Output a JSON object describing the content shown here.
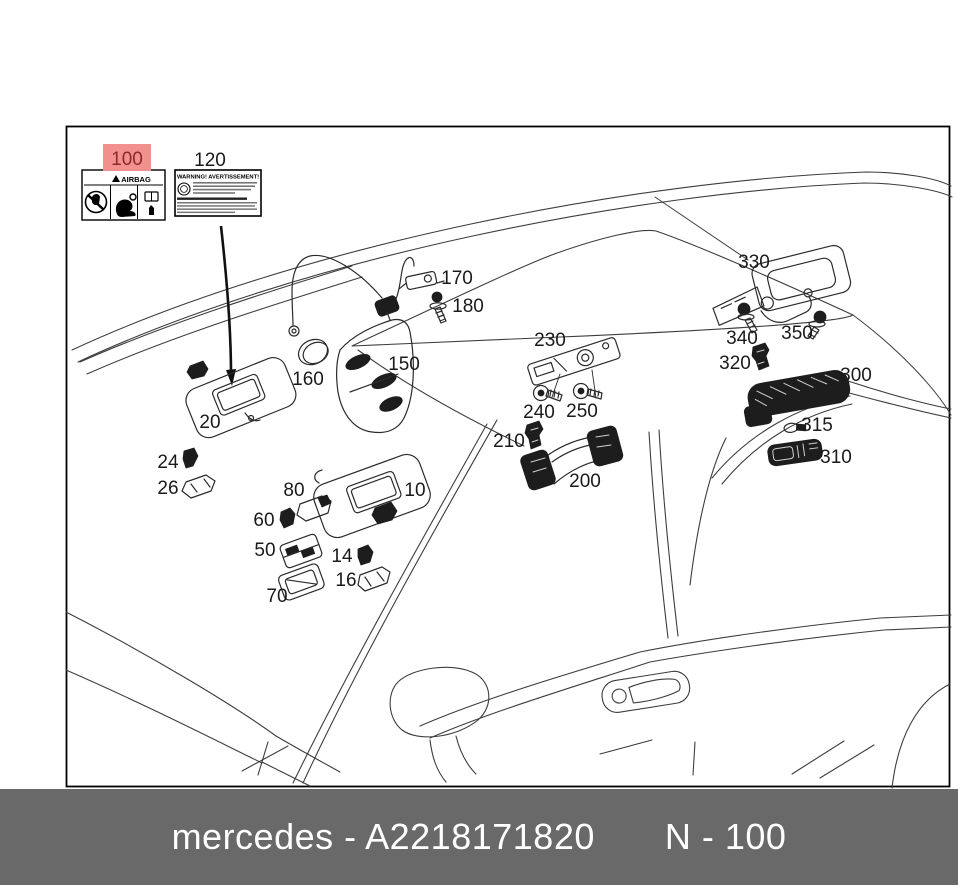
{
  "footer": {
    "part_number": "mercedes - A2218171820",
    "page_ref": "N - 100",
    "bg": "#696969",
    "text_color": "#ffffff"
  },
  "diagram": {
    "frame_color": "#000000",
    "line_color": "#3d3d3d",
    "highlight": {
      "bg": "#f2908e",
      "text": "#8c2b26"
    },
    "airbag_label": {
      "callout": "100",
      "title": "AIRBAG",
      "icons": [
        "warning-triangle-icon",
        "no-child-seat-icon",
        "airbag-child-seat-icon",
        "manual-book-hand-icon"
      ]
    },
    "warning_label": {
      "callout": "120",
      "title": "WARNING! AVERTISSEMENT!",
      "icons": [
        "round-certification-icon"
      ]
    },
    "callouts": [
      {
        "label": "100",
        "x": 127,
        "y": 165,
        "highlighted": true
      },
      {
        "label": "120",
        "x": 210,
        "y": 166,
        "highlighted": false
      },
      {
        "label": "170",
        "x": 457,
        "y": 284,
        "highlighted": false
      },
      {
        "label": "180",
        "x": 468,
        "y": 312,
        "highlighted": false
      },
      {
        "label": "150",
        "x": 404,
        "y": 370,
        "highlighted": false
      },
      {
        "label": "160",
        "x": 308,
        "y": 385,
        "highlighted": false
      },
      {
        "label": "20",
        "x": 210,
        "y": 428,
        "highlighted": false
      },
      {
        "label": "24",
        "x": 168,
        "y": 468,
        "highlighted": false
      },
      {
        "label": "26",
        "x": 168,
        "y": 494,
        "highlighted": false
      },
      {
        "label": "80",
        "x": 294,
        "y": 496,
        "highlighted": false
      },
      {
        "label": "60",
        "x": 264,
        "y": 526,
        "highlighted": false
      },
      {
        "label": "50",
        "x": 265,
        "y": 556,
        "highlighted": false
      },
      {
        "label": "70",
        "x": 277,
        "y": 602,
        "highlighted": false
      },
      {
        "label": "14",
        "x": 342,
        "y": 562,
        "highlighted": false
      },
      {
        "label": "16",
        "x": 346,
        "y": 586,
        "highlighted": false
      },
      {
        "label": "10",
        "x": 415,
        "y": 496,
        "highlighted": false
      },
      {
        "label": "230",
        "x": 550,
        "y": 346,
        "highlighted": false
      },
      {
        "label": "240",
        "x": 539,
        "y": 418,
        "highlighted": false
      },
      {
        "label": "250",
        "x": 582,
        "y": 417,
        "highlighted": false
      },
      {
        "label": "210",
        "x": 509,
        "y": 447,
        "highlighted": false
      },
      {
        "label": "200",
        "x": 585,
        "y": 487,
        "highlighted": false
      },
      {
        "label": "330",
        "x": 754,
        "y": 268,
        "highlighted": false
      },
      {
        "label": "340",
        "x": 742,
        "y": 344,
        "highlighted": false
      },
      {
        "label": "350",
        "x": 797,
        "y": 339,
        "highlighted": false
      },
      {
        "label": "320",
        "x": 735,
        "y": 369,
        "highlighted": false
      },
      {
        "label": "300",
        "x": 856,
        "y": 381,
        "highlighted": false
      },
      {
        "label": "315",
        "x": 817,
        "y": 431,
        "highlighted": false
      },
      {
        "label": "310",
        "x": 836,
        "y": 463,
        "highlighted": false
      }
    ]
  }
}
